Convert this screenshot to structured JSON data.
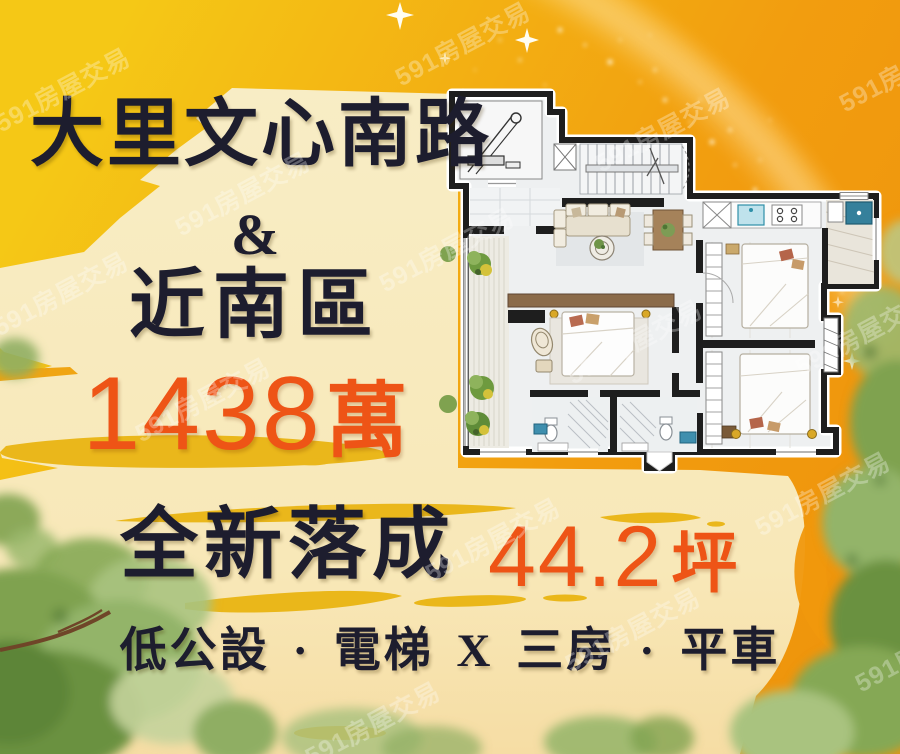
{
  "poster": {
    "headline_line1": "大里文心南路",
    "ampersand": "&",
    "headline_line2": "近南區",
    "price": {
      "value": "1438",
      "unit": "萬"
    },
    "status_label": "全新落成",
    "area": {
      "value": "44.2",
      "unit": "坪"
    },
    "features_line": "低公設 · 電梯 X 三房 · 平車"
  },
  "watermark": {
    "text": "591房屋交易"
  },
  "floorplan": {
    "description": "three-bedroom apartment floor plan with elevator, stairs, living room, dining area, kitchen, two bathrooms and balcony"
  },
  "colors": {
    "background_yellow": "#f5c816",
    "background_orange": "#ef950c",
    "cream_panel": "#f8edc5",
    "headline_navy": "#1d1d2e",
    "price_orange": "#ee5416",
    "brush_yellow": "#e9b512",
    "tree_green": "#7fa24f"
  }
}
